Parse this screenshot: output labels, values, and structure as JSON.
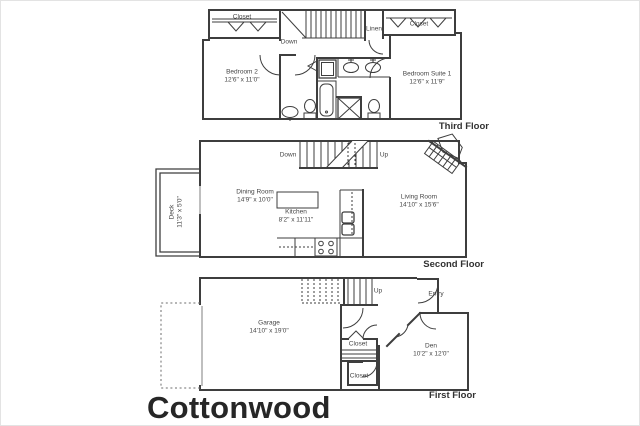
{
  "title": "Cottonwood",
  "colors": {
    "line": "#3e3e3e",
    "text": "#454545",
    "title": "#262626",
    "background": "#ffffff"
  },
  "floors": {
    "third": {
      "label": "Third Floor",
      "closet_left": "Closet",
      "closet_right": "Closet",
      "linen": "Linen",
      "down": "Down",
      "bedroom2": {
        "name": "Bedroom 2",
        "dims": "12'6\" x 11'0\""
      },
      "suite1": {
        "name": "Bedroom Suite 1",
        "dims": "12'6\" x 11'9\""
      }
    },
    "second": {
      "label": "Second Floor",
      "down": "Down",
      "up": "Up",
      "deck": {
        "name": "Deck",
        "dims": "11'3\" x 5'0\""
      },
      "dining": {
        "name": "Dining Room",
        "dims": "14'9\" x 10'0\""
      },
      "kitchen": {
        "name": "Kitchen",
        "dims": "8'2\" x 11'11\""
      },
      "living": {
        "name": "Living Room",
        "dims": "14'10\" x 15'6\""
      }
    },
    "first": {
      "label": "First Floor",
      "up": "Up",
      "entry": "Entry",
      "garage": {
        "name": "Garage",
        "dims": "14'10\" x 19'0\""
      },
      "closet_upper": "Closet",
      "closet_lower": "Closet",
      "den": {
        "name": "Den",
        "dims": "10'2\" x 12'0\""
      }
    }
  }
}
